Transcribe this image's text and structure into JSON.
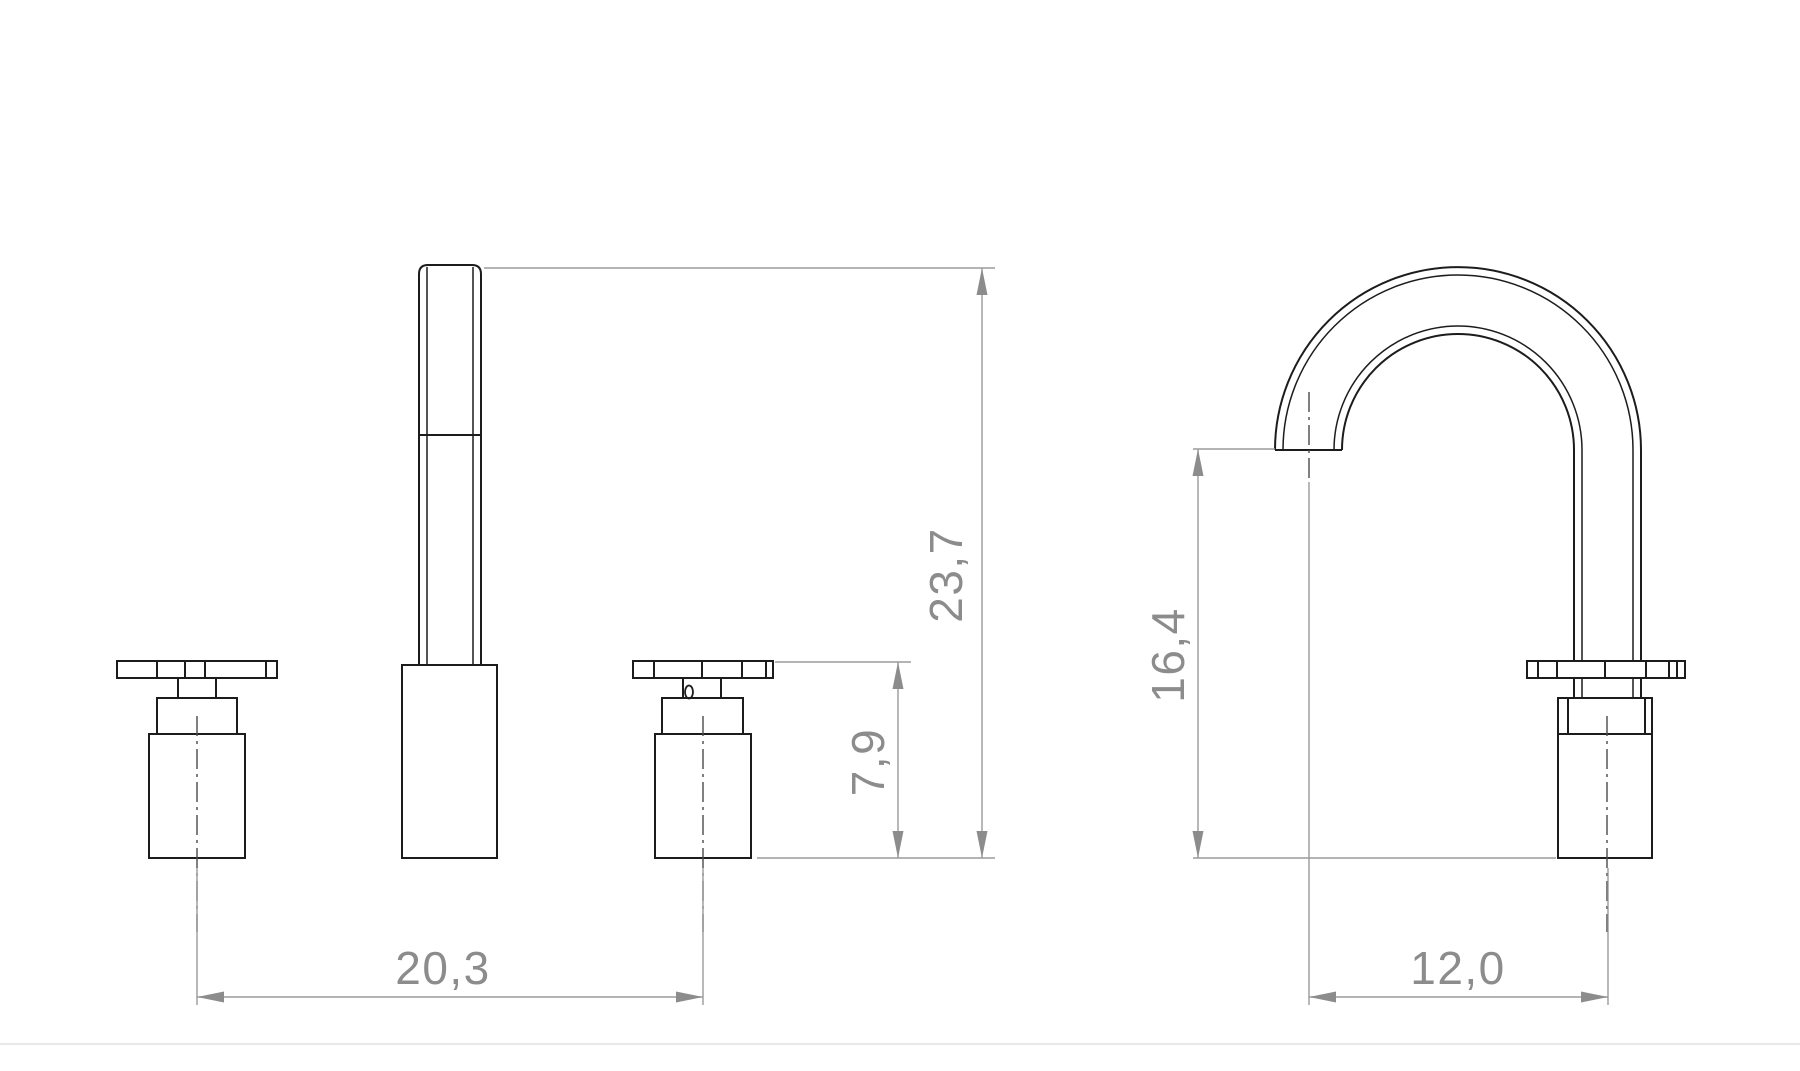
{
  "drawing": {
    "colors": {
      "background": "#ffffff",
      "outline": "#1c1c1c",
      "dimension_line": "#9b9b9b",
      "dimension_text": "#8c8c8c",
      "centerline": "#4a4a4a",
      "footer_divider": "#e9e9e9"
    },
    "front_view": {
      "dimensions": {
        "total_height": "23,7",
        "handle_height": "7,9",
        "handle_spacing": "20,3"
      }
    },
    "side_view": {
      "dimensions": {
        "spout_height": "16,4",
        "spout_reach": "12,0"
      }
    }
  }
}
